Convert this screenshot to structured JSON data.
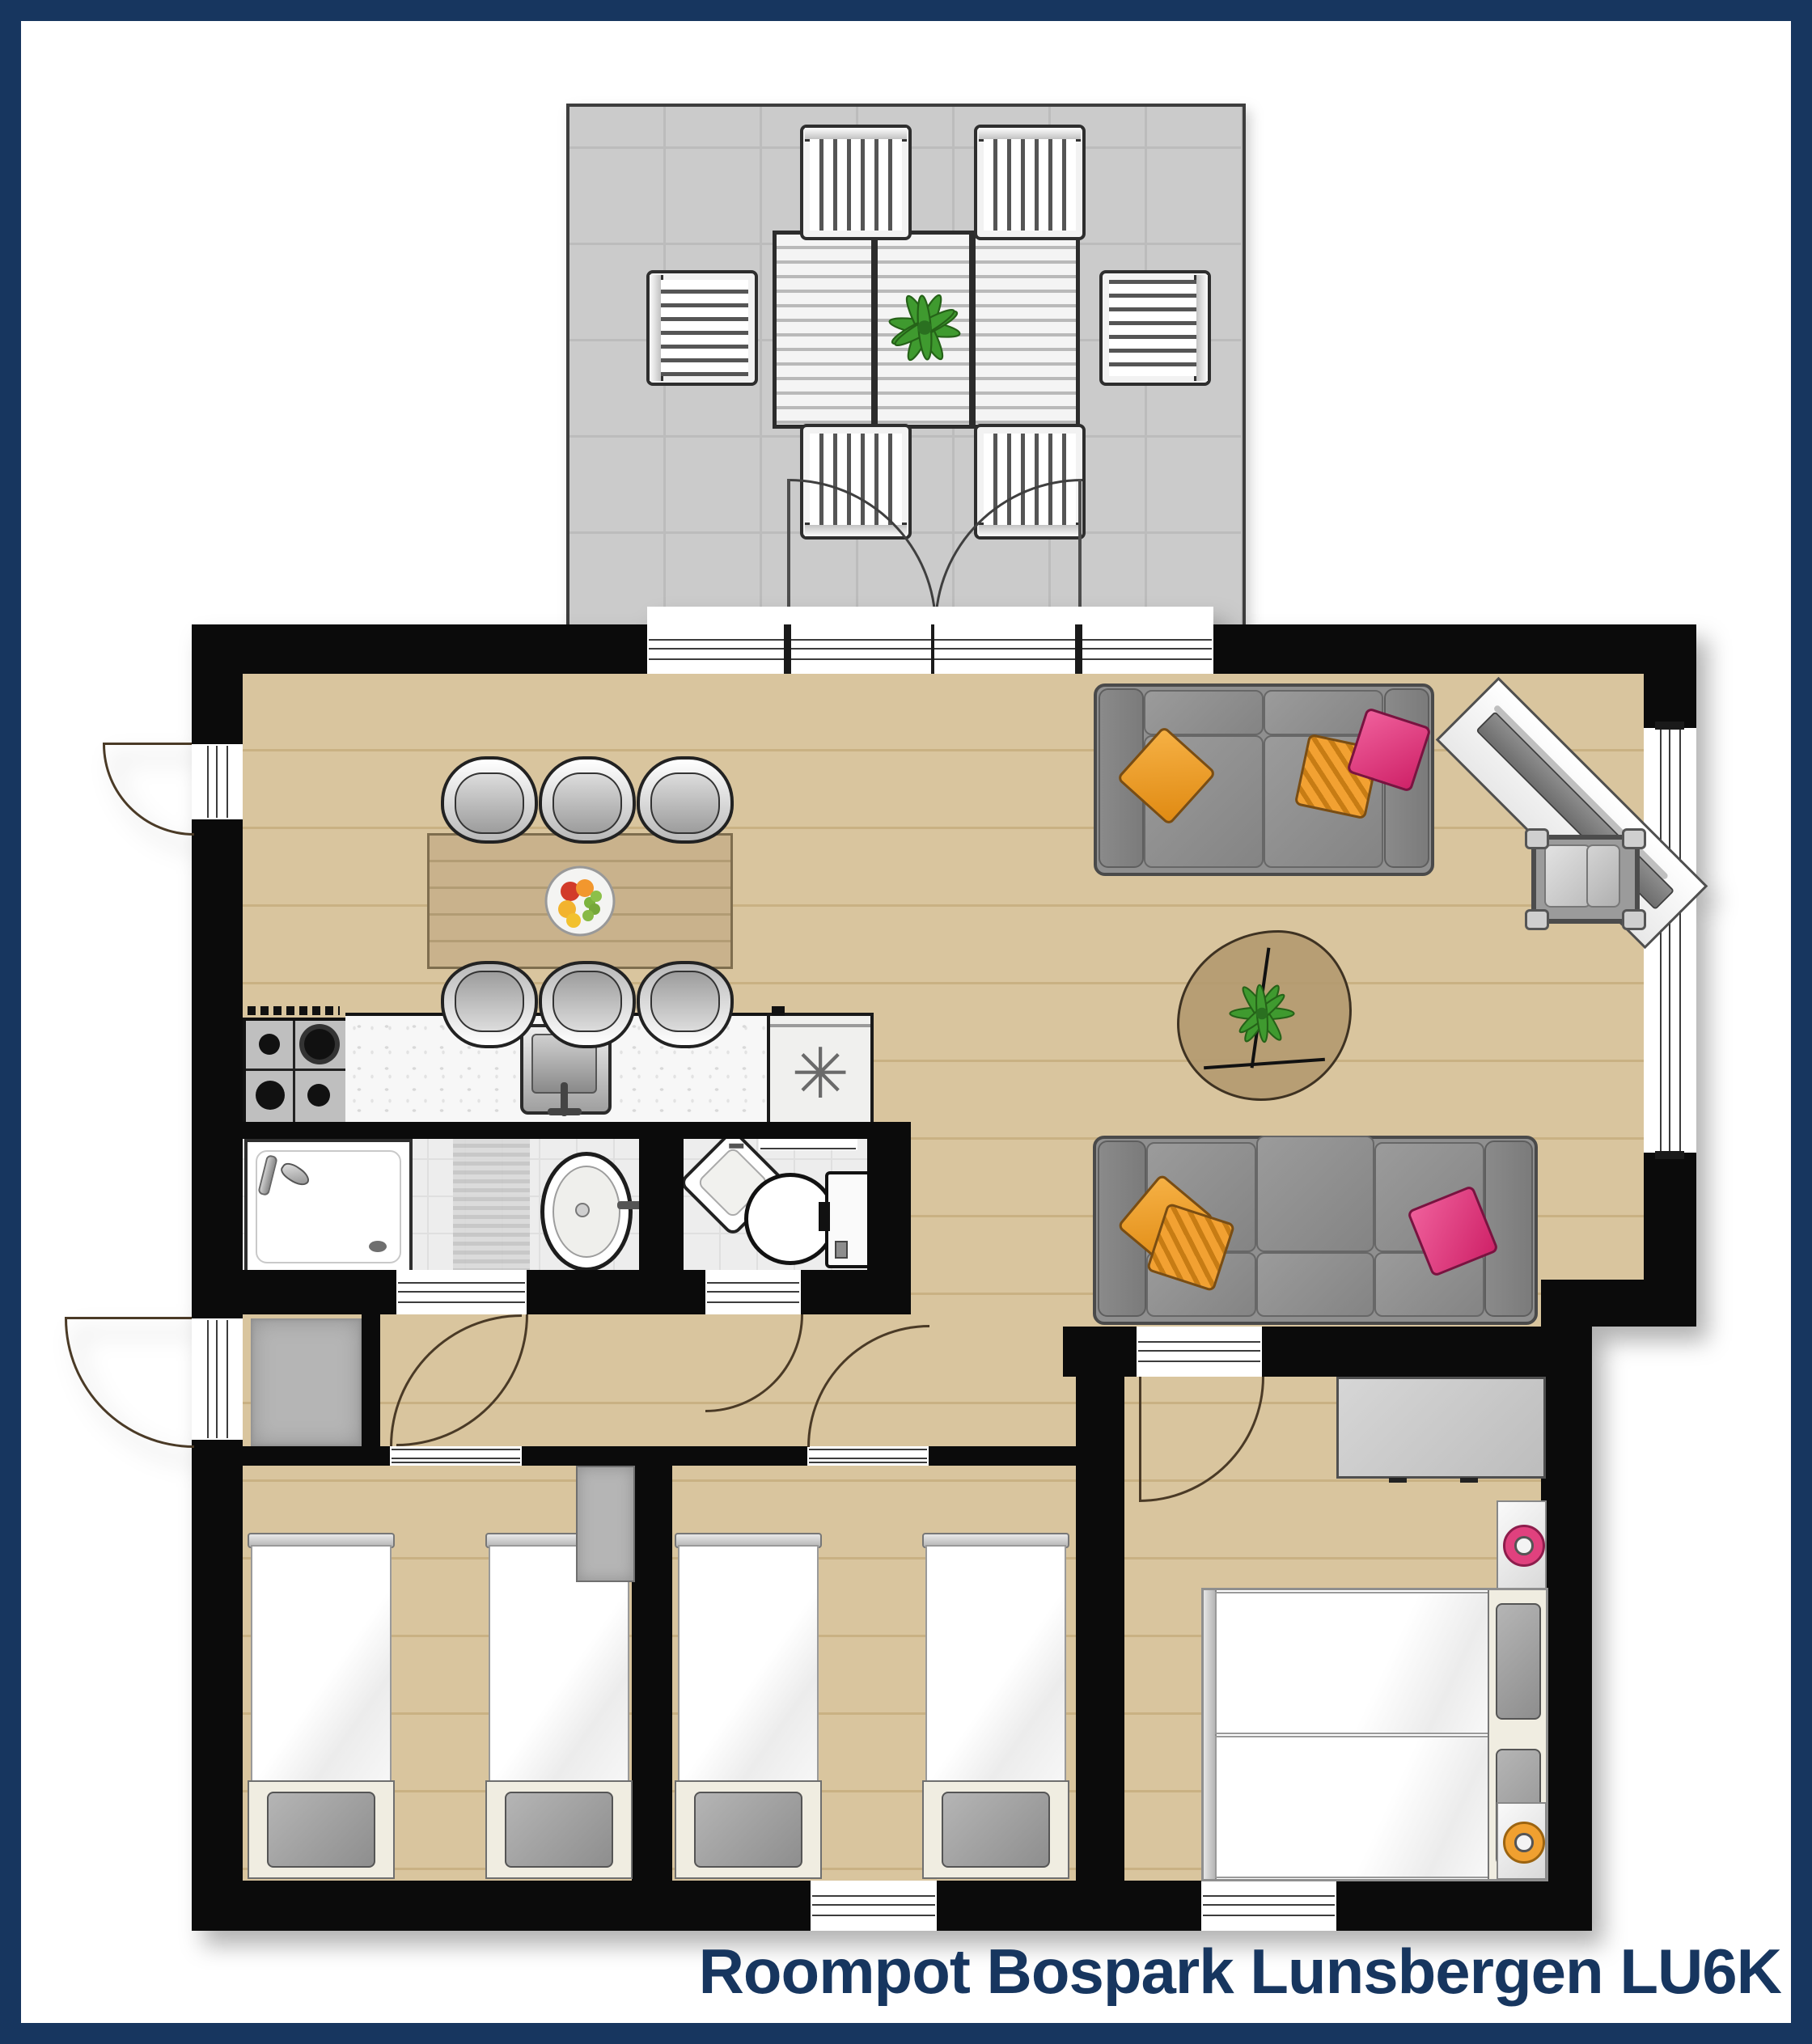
{
  "caption": "Roompot Bospark Lunsbergen LU6K",
  "icons": {
    "utility_asterisk": "✳"
  },
  "colors": {
    "frame": "#17365f",
    "wall": "#0b0b0b",
    "wood": "#d9c59e",
    "woodline": "#c9b183",
    "terrace": "#cbcbcb",
    "terraceline": "#bcbcbc",
    "tablewood": "#c9b28c",
    "tile": "#ededed",
    "tileline": "#dfdfdf",
    "counter": "#f7f7f7",
    "sofa": "#8f8f8f",
    "sofadark": "#7a7a7a",
    "sofaedge": "#4a4a4a",
    "orange": "#f2a132",
    "pink": "#e03a80",
    "plantgreen": "#3f9a2f",
    "deskgray": "#c8c8c8",
    "mat": "#b5b5b5",
    "bed": "#fcfcfc",
    "headboard": "#f0ede1",
    "pillow": "#a2a2a2",
    "lamppink": "#e0417e",
    "lamporange": "#f0a030",
    "arccolor": "#4a3a26",
    "caption": "#17365f",
    "glass": "#3c3c3c"
  }
}
